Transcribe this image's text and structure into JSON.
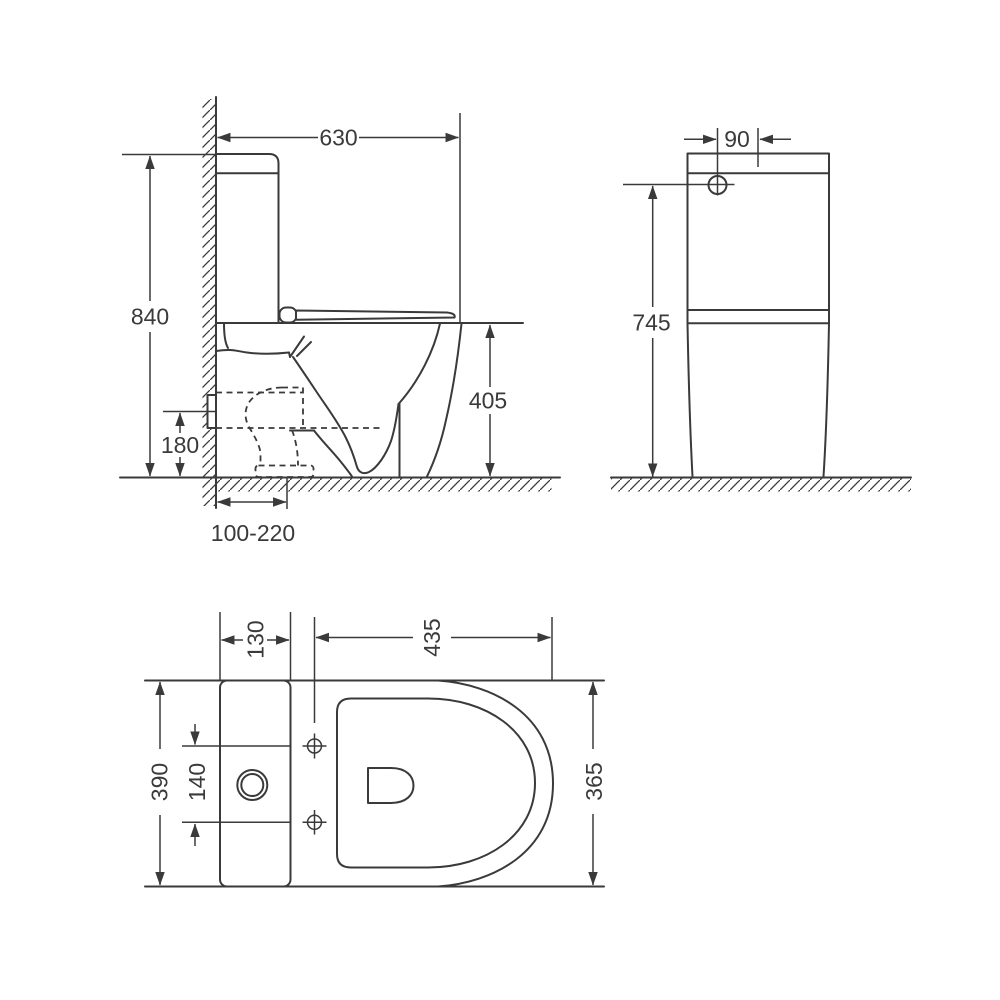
{
  "meta": {
    "drawing_type": "dimensioned technical drawing",
    "subject": "back-to-wall close-coupled toilet (side, rear and top views)",
    "background_color": "#ffffff",
    "line_color": "#3a3a3a"
  },
  "dimensions": {
    "side_view": {
      "depth": "630",
      "height": "840",
      "bowl_height": "405",
      "outlet_height": "180",
      "outlet_range": "100-220"
    },
    "rear_view": {
      "inlet_offset": "90",
      "cistern_height": "745"
    },
    "top_view": {
      "cistern_depth": "130",
      "seat_length": "435",
      "cistern_width": "390",
      "hole_spacing": "140",
      "seat_width": "365"
    }
  }
}
